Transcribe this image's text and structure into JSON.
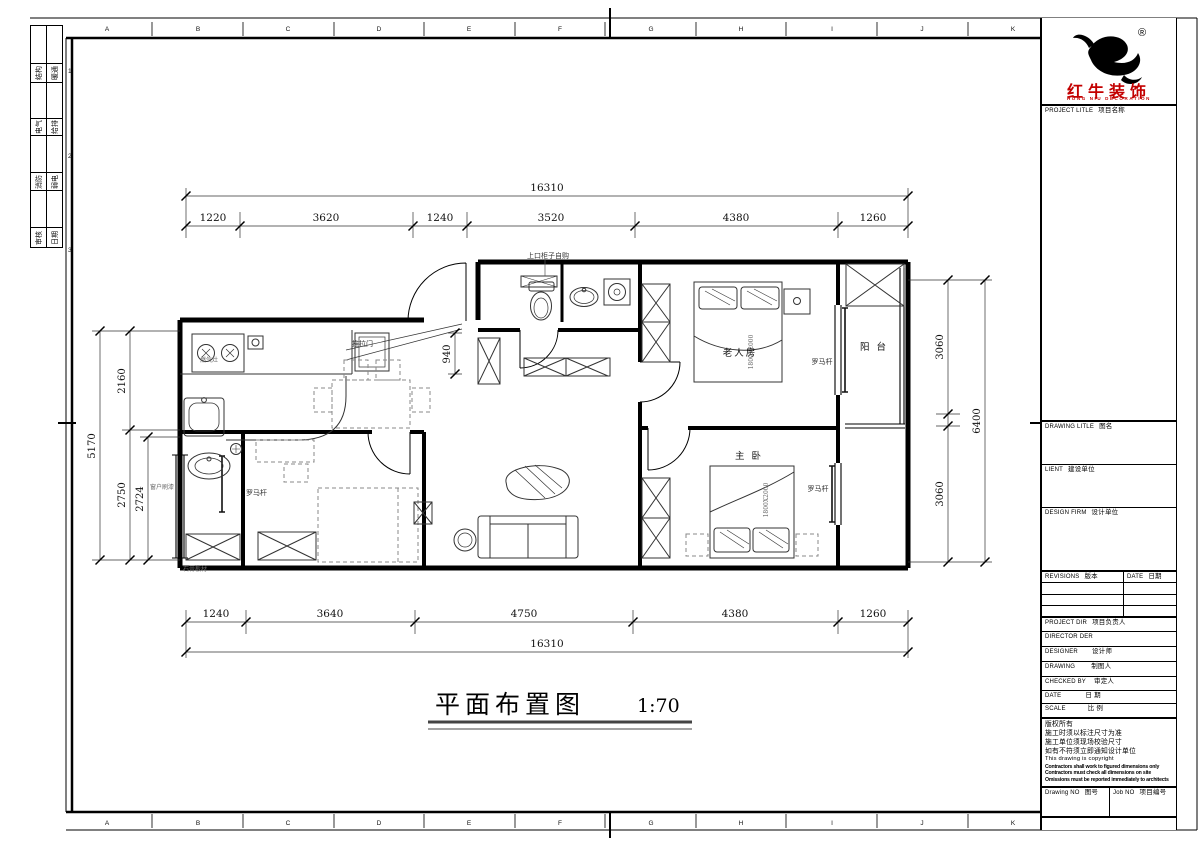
{
  "colors": {
    "brand_red": "#c30000",
    "line": "#000000"
  },
  "sheet": {
    "grid_letters": [
      "A",
      "B",
      "C",
      "D",
      "E",
      "F",
      "G",
      "H",
      "I",
      "J",
      "K"
    ],
    "row_numbers": [
      "1",
      "2",
      "3"
    ],
    "signoff_cells": [
      {
        "a": "结构",
        "b": "暖通"
      },
      {
        "a": "电气",
        "b": "给排"
      },
      {
        "a": "消防",
        "b": "弱电"
      },
      {
        "a": "审核",
        "b": "日期"
      }
    ]
  },
  "plan": {
    "view_title": "平面布置图",
    "view_scale": "1:70",
    "rooms": {
      "elder": "老人房",
      "master": "主 卧",
      "balcony": "阳 台"
    },
    "labels": {
      "upper_cabinet": "上口柜子自购",
      "sliding_door": "推拉门",
      "curtain_rod": "罗马杆",
      "window_note": "窗户刷漆",
      "gypsum_note": "石膏板材",
      "bed_size": "1800X2000",
      "stove": "燃气灶"
    },
    "dims": {
      "top_total": "16310",
      "top_segments": [
        "1220",
        "3620",
        "1240",
        "3520",
        "4380",
        "1260"
      ],
      "bottom_segments": [
        "1240",
        "3640",
        "4750",
        "4380",
        "1260"
      ],
      "bottom_total": "16310",
      "left_total": "5170",
      "left_segments": [
        "2160",
        "2750"
      ],
      "left_inner": "2724",
      "right_segments": [
        "3060",
        "3060"
      ],
      "right_total": "6400",
      "corridor": "940"
    }
  },
  "title_block": {
    "company_name": "红牛装饰",
    "company_name_en": "HONG NIU DECORATION",
    "reg_mark": "®",
    "fields": {
      "project": {
        "en": "PROJECT LITLE",
        "zh": "项目名称"
      },
      "drawing_title": {
        "en": "DRAWING LITLE",
        "zh": "图名"
      },
      "client": {
        "en": "LIENT",
        "zh": "建设单位"
      },
      "design_firm": {
        "en": "DESIGN FIRM",
        "zh": "设计单位"
      },
      "revisions": {
        "en": "REVISIONS",
        "zh": "版本"
      },
      "rev_date": {
        "en": "DATE",
        "zh": "日期"
      },
      "project_dir": {
        "en": "PROJECT DIR",
        "zh": "项目负责人"
      },
      "director": {
        "en": "DIRECTOR DER",
        "zh": ""
      },
      "designer": {
        "en": "DESIGNER",
        "zh": "设计师"
      },
      "drawing_by": {
        "en": "DRAWING",
        "zh": "制图人"
      },
      "checked_by": {
        "en": "CHECKED BY",
        "zh": "审定人"
      },
      "date": {
        "en": "DATE",
        "zh": "日 期"
      },
      "scale": {
        "en": "SCALE",
        "zh": "比 例"
      },
      "drawing_no": {
        "en": "Drawing NO",
        "zh": "图号"
      },
      "job_no": {
        "en": "Job NO",
        "zh": "项目编号"
      }
    },
    "copyright": {
      "zh": [
        "版权所有",
        "施工时须以标注尺寸为准",
        "施工单位须现场校验尺寸",
        "如有不符须立即通知设计单位"
      ],
      "en": [
        "This drawing is copyright",
        "Contractors shall work to figured dimensions only",
        "Contractors must check all dimensions on site",
        "Omissions must be reported immediately to architects"
      ]
    }
  }
}
